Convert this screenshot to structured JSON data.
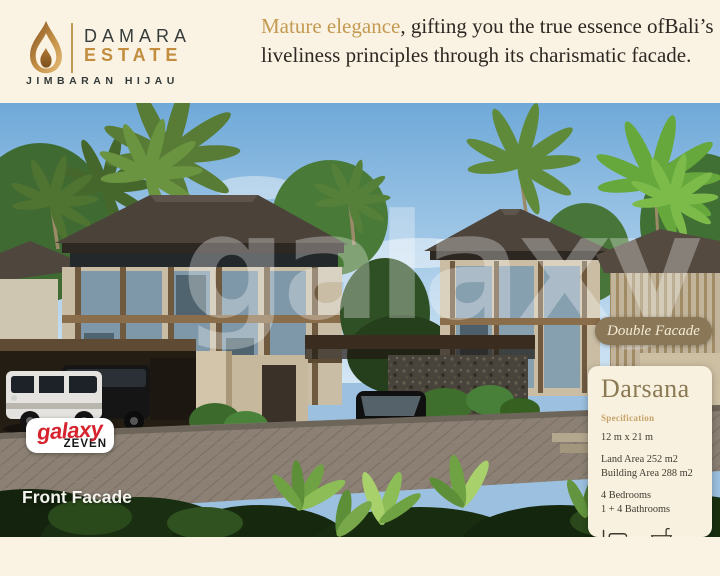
{
  "page": {
    "background": "#faf3e3"
  },
  "logo": {
    "brand_top": "DAMARA",
    "brand_bottom": "ESTATE",
    "subtitle": "JIMBARAN HIJAU",
    "gold": "#c28d3f",
    "dark": "#363d3c"
  },
  "headline": {
    "highlight": "Mature elegance",
    "rest": ", gifting you the true essence ofBali’s liveliness principles through its charismatic facade.",
    "highlight_color": "#c49a52",
    "text_color": "#2d2823"
  },
  "photo": {
    "watermark": "galaxy",
    "caption": "Front Facade",
    "badge": {
      "label": "Double Facade",
      "bg": "#8a7757",
      "text_color": "#f3ead3"
    }
  },
  "card": {
    "title": "Darsana",
    "section": "Specification",
    "dimensions": "12 m x 21 m",
    "land_area": "Land Area 252 m2",
    "building_area": "Building Area 288 m2",
    "bedrooms": "4 Bedrooms",
    "bathrooms": "1 + 4 Bathrooms",
    "bed_count": "4",
    "bath_count": "4 + 1",
    "bg": "#f8f1e0",
    "title_color": "#8a7952"
  },
  "footer": {
    "brand": "galaxy",
    "sub_brand": "ZEVEN",
    "brand_color": "#d6232e",
    "sub_color": "#161616"
  }
}
